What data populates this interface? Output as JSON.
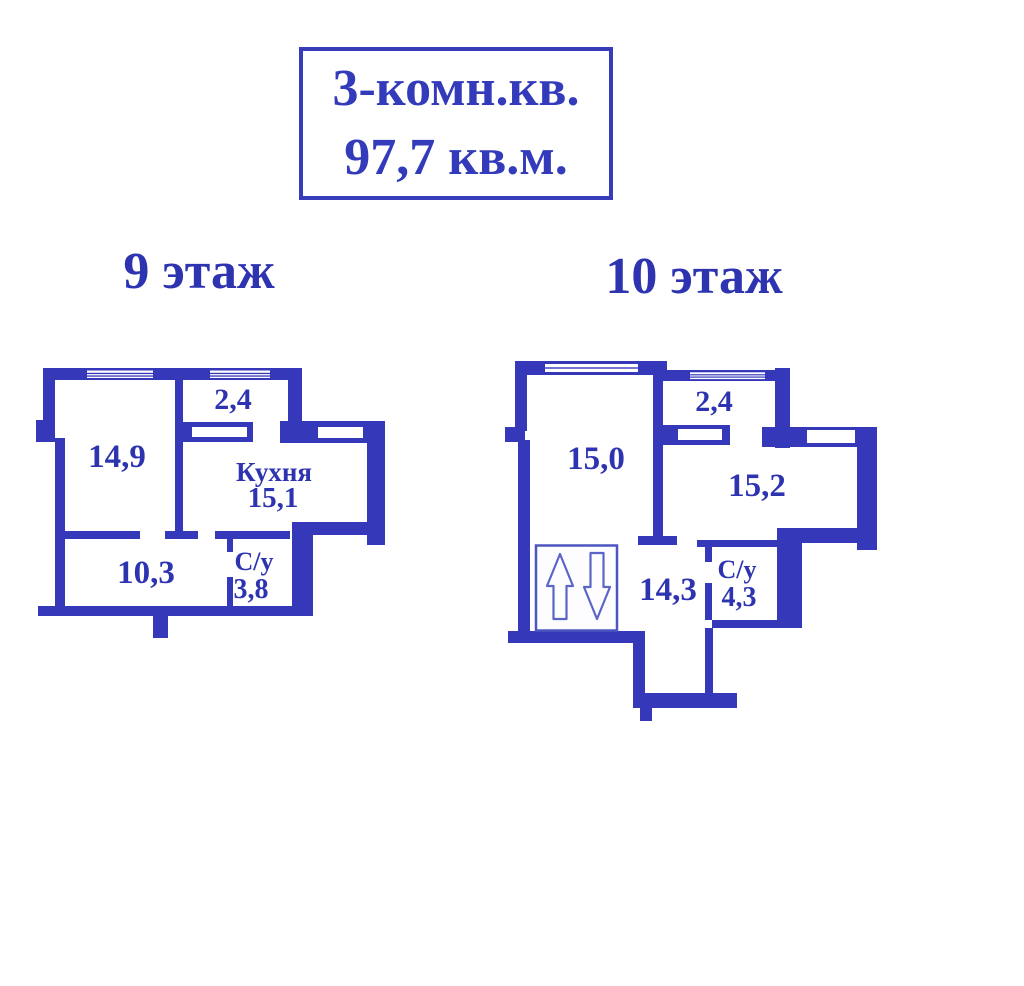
{
  "title": {
    "line1": "3-комн.кв.",
    "line2": "97,7 кв.м."
  },
  "floor9": {
    "label": "9 этаж",
    "room_main_area": "14,9",
    "balcony_area": "2,4",
    "kitchen_name": "Кухня",
    "kitchen_area": "15,1",
    "hall_area": "10,3",
    "wc_name": "С/у",
    "wc_area": "3,8"
  },
  "floor10": {
    "label": "10 этаж",
    "room_main_area": "15,0",
    "balcony_area": "2,4",
    "room_second_area": "15,2",
    "hall_area": "14,3",
    "wc_name": "С/у",
    "wc_area": "4,3"
  },
  "icons": {
    "stairs_up": "stairs-up-arrow",
    "stairs_down": "stairs-down-arrow",
    "window": "window"
  },
  "colors": {
    "wall": "#3538b8",
    "label_text": "#2e34b0",
    "stairs_arrow": "#5b65c8",
    "background": "#ffffff"
  }
}
